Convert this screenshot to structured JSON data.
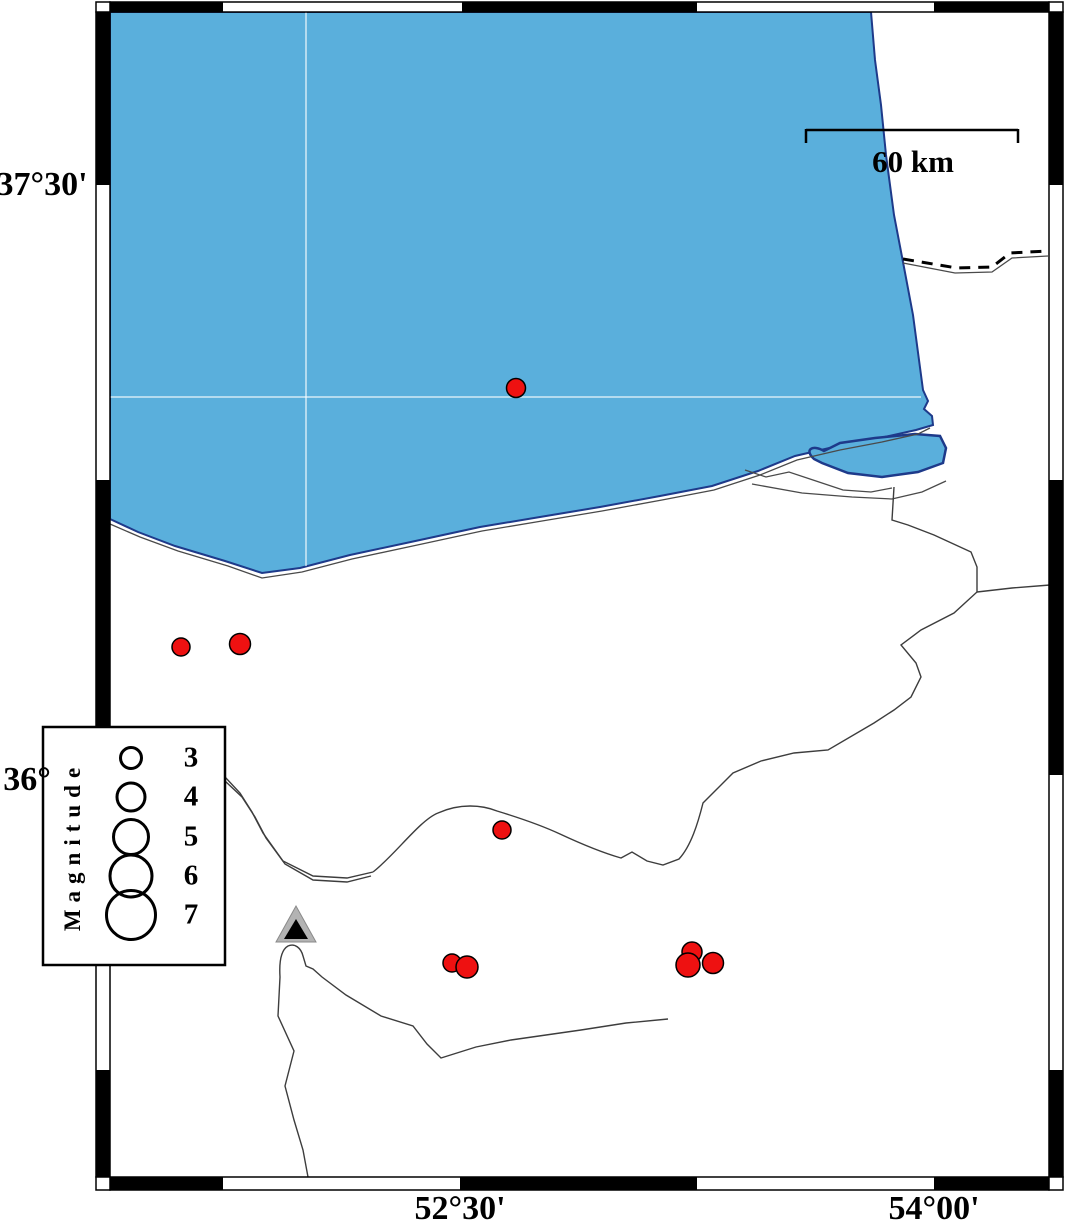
{
  "figure": {
    "description": "Seismicity map of the southeastern Caspian Sea region with earthquake epicenters, one station/volcano triangle, magnitude legend and scale bar"
  },
  "colors": {
    "sea": "#5aafdc",
    "sea_outline": "#1e3a8a",
    "epicenter": "#ee1111",
    "triangle_outer": "#b3b3b3",
    "triangle_inner": "#000000",
    "river_line": "#4a4a4a",
    "gridline": "rgba(255,255,255,0.55)"
  },
  "labels": {
    "lat_top": "37°30'",
    "lat_mid": "36°",
    "lon_left": "52°30'",
    "lon_right": "54°00'"
  },
  "scalebar": {
    "label": "60 km"
  },
  "legend": {
    "title": "Magnitude",
    "entries": [
      {
        "magnitude": "3",
        "radius_px": 10.5,
        "cy": 758
      },
      {
        "magnitude": "4",
        "radius_px": 14,
        "cy": 797
      },
      {
        "magnitude": "5",
        "radius_px": 17.5,
        "cy": 837
      },
      {
        "magnitude": "6",
        "radius_px": 21,
        "cy": 876
      },
      {
        "magnitude": "7",
        "radius_px": 24.5,
        "cy": 915
      }
    ],
    "circle_cx": 131,
    "label_cx": 191
  },
  "map": {
    "earthquakes": [
      {
        "x": 516,
        "y": 388,
        "d": 19
      },
      {
        "x": 181,
        "y": 647,
        "d": 18
      },
      {
        "x": 240,
        "y": 644,
        "d": 21
      },
      {
        "x": 502,
        "y": 830,
        "d": 18
      },
      {
        "x": 452,
        "y": 963,
        "d": 18
      },
      {
        "x": 467,
        "y": 967,
        "d": 22
      },
      {
        "x": 692,
        "y": 952,
        "d": 20
      },
      {
        "x": 688,
        "y": 965,
        "d": 24
      },
      {
        "x": 713,
        "y": 963,
        "d": 21
      }
    ],
    "station_triangle": {
      "x": 296,
      "y": 925
    }
  }
}
